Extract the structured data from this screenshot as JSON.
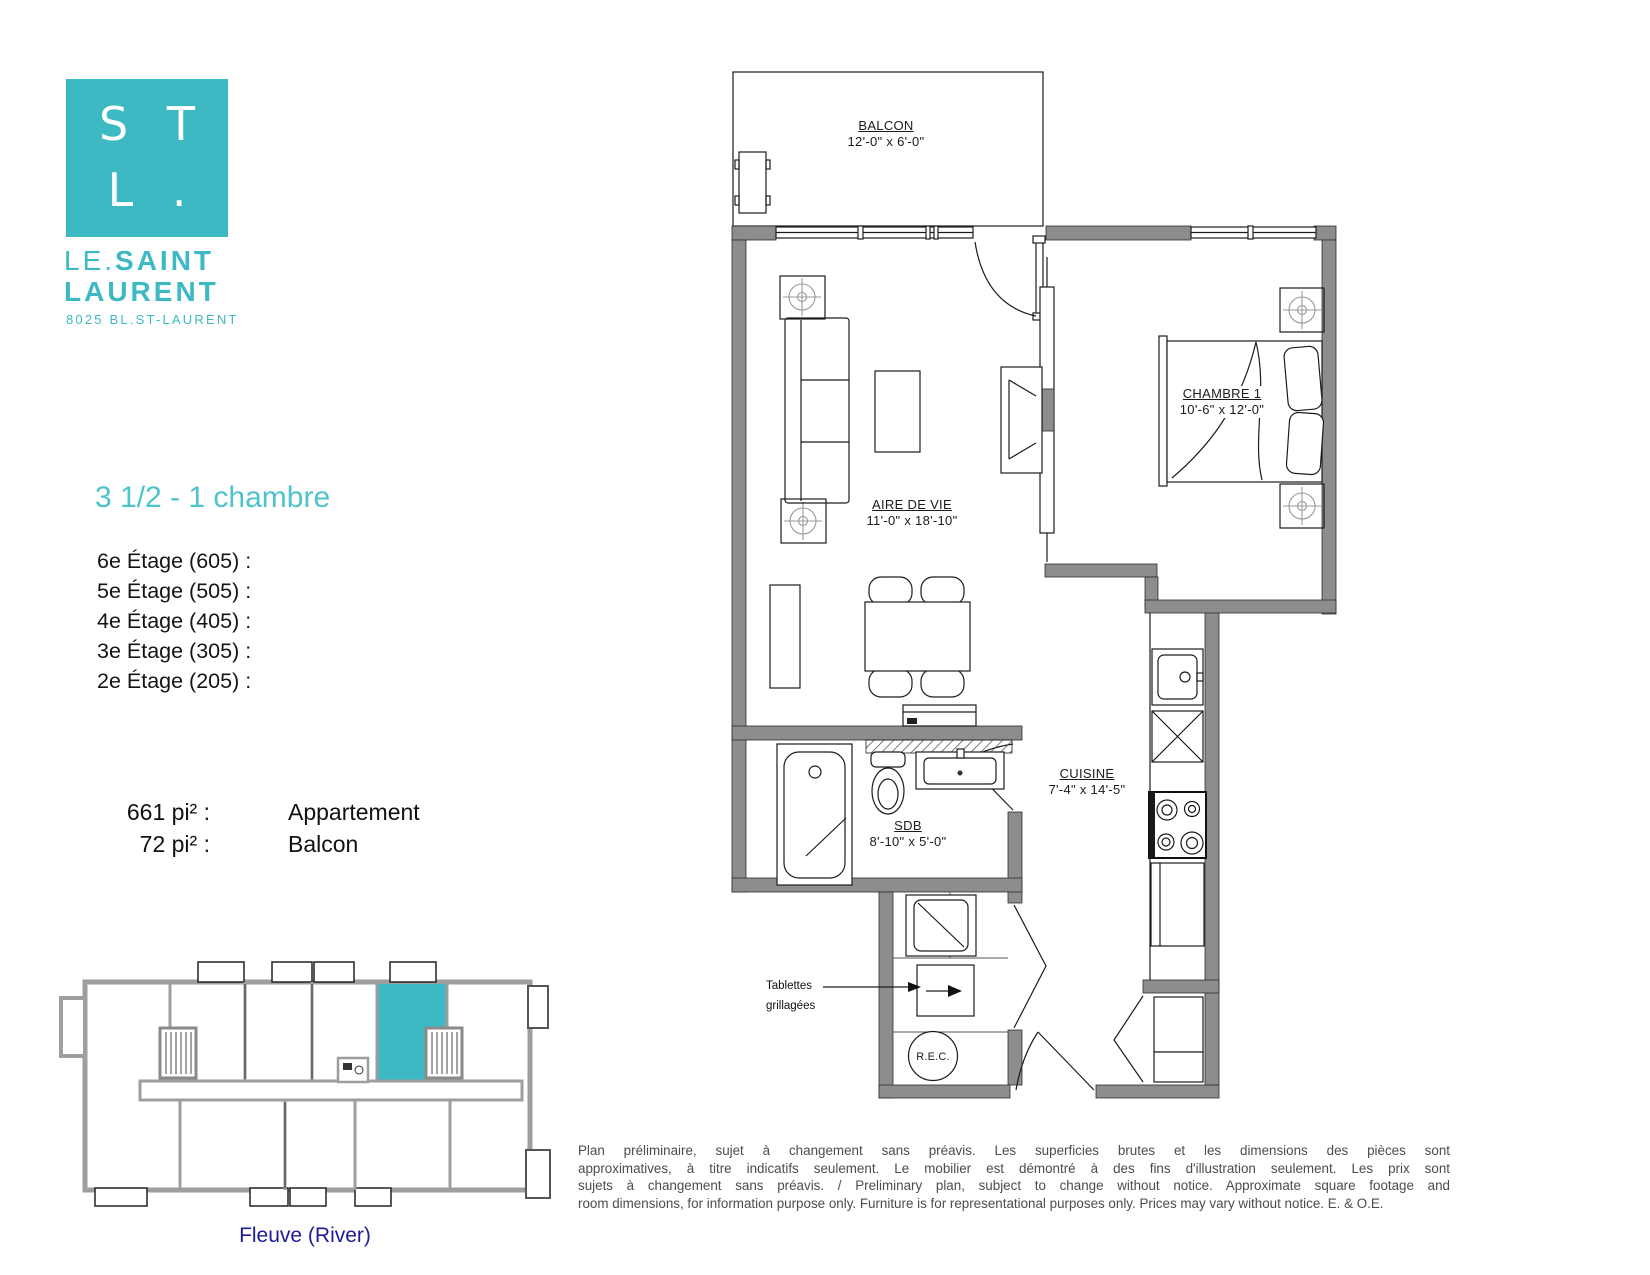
{
  "brand": {
    "logo_line1": "S T",
    "logo_line2": "L .",
    "name_light": "LE.",
    "name_bold": "SAINT",
    "name_line2": "LAURENT",
    "address": "8025 BL.ST-LAURENT"
  },
  "unit": {
    "title": "3 1/2 - 1 chambre",
    "floors": [
      "6e Étage (605) :",
      "5e Étage (505) :",
      "4e Étage (405) :",
      "3e Étage (305) :",
      "2e Étage (205) :"
    ],
    "areas": [
      {
        "value": "661 pi² :",
        "label": "Appartement"
      },
      {
        "value": "72 pi² :",
        "label": "Balcon"
      }
    ]
  },
  "overview": {
    "river_label": "Fleuve (River)"
  },
  "plan": {
    "rooms": {
      "balcon": {
        "name": "BALCON",
        "dims": "12'-0\" x 6'-0\""
      },
      "aire_de_vie": {
        "name": "AIRE DE VIE",
        "dims": "11'-0\" x 18'-10\""
      },
      "chambre1": {
        "name": "CHAMBRE 1",
        "dims": "10'-6\" x 12'-0\""
      },
      "sdb": {
        "name": "SDB",
        "dims": "8'-10\" x 5'-0\""
      },
      "cuisine": {
        "name": "CUISINE",
        "dims": "7'-4\" x 14'-5\""
      }
    },
    "annotations": {
      "shelves_line1": "Tablettes",
      "shelves_line2": "grillagées",
      "water_heater": "R.E.C."
    }
  },
  "disclaimer": {
    "lines": [
      "Plan préliminaire, sujet à changement sans préavis. Les superficies brutes et les dimensions des pièces sont",
      "approximatives, à titre indicatifs seulement. Le mobilier est démontré à des fins d'illustration seulement. Les prix sont",
      "sujets à changement sans préavis. / Preliminary plan, subject to change without notice. Approximate square footage and",
      "room dimensions, for information purpose only. Furniture is for representational purposes only. Prices may vary without notice. E. & O.E."
    ]
  },
  "colors": {
    "teal": "#3db9c4",
    "heading_teal": "#4cc3cd",
    "wall_gray": "#8d8d8d",
    "river_blue": "#1c1c96",
    "disclaimer_gray": "#4c4c4c"
  }
}
